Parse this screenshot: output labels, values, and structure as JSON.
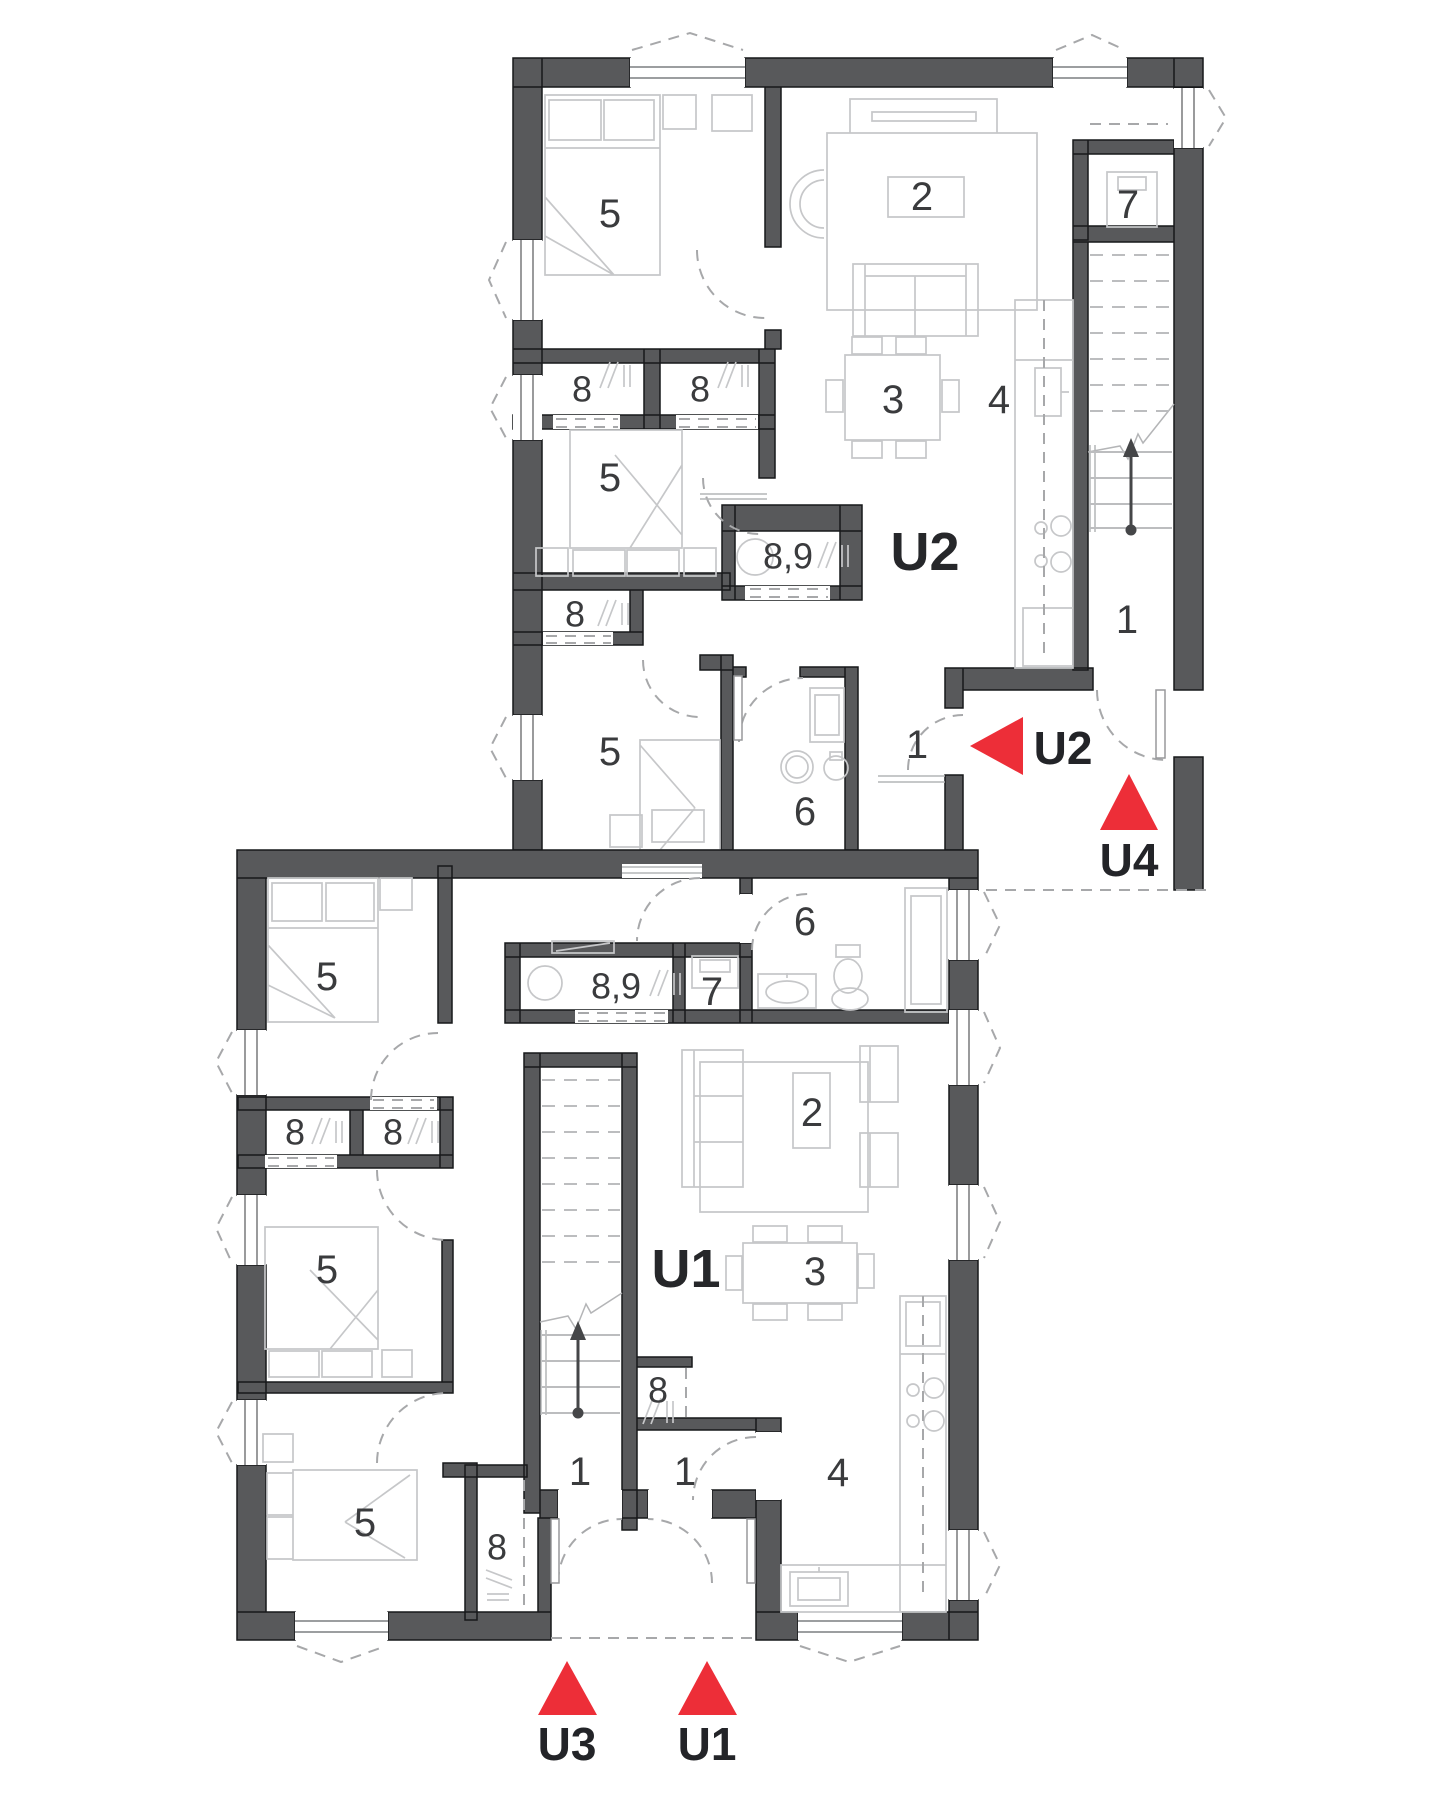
{
  "plan": {
    "colors": {
      "wall": "#58595b",
      "furniture": "#c6c7c9",
      "dash": "#a7a8aa",
      "red": "#ed2e38",
      "text": "#3a3b3d",
      "bold_text": "#26272a"
    },
    "units": {
      "u2": {
        "label": "U2",
        "rooms": {
          "bedroom_top": "5",
          "living": "2",
          "dining": "3",
          "kitchen": "4",
          "closet_a": "8",
          "closet_b": "8",
          "bedroom_mid": "5",
          "bathroom": "8,9",
          "closet_c": "8",
          "bedroom_low": "5",
          "wc": "6",
          "hall": "1",
          "storage": "7",
          "stair_hall": "1"
        }
      },
      "u1": {
        "label": "U1",
        "rooms": {
          "bedroom_top": "5",
          "closet_a": "8",
          "closet_b": "8",
          "bedroom_mid": "5",
          "bedroom_low": "5",
          "closet_c": "8",
          "closet_d": "8",
          "bathroom": "8,9",
          "storage": "7",
          "wc": "6",
          "living": "2",
          "dining": "3",
          "kitchen": "4",
          "hall_left": "1",
          "hall_right": "1"
        }
      }
    },
    "markers": [
      {
        "id": "u2",
        "label": "U2",
        "direction": "left"
      },
      {
        "id": "u4",
        "label": "U4",
        "direction": "up"
      },
      {
        "id": "u3",
        "label": "U3",
        "direction": "up"
      },
      {
        "id": "u1",
        "label": "U1",
        "direction": "up"
      }
    ]
  }
}
